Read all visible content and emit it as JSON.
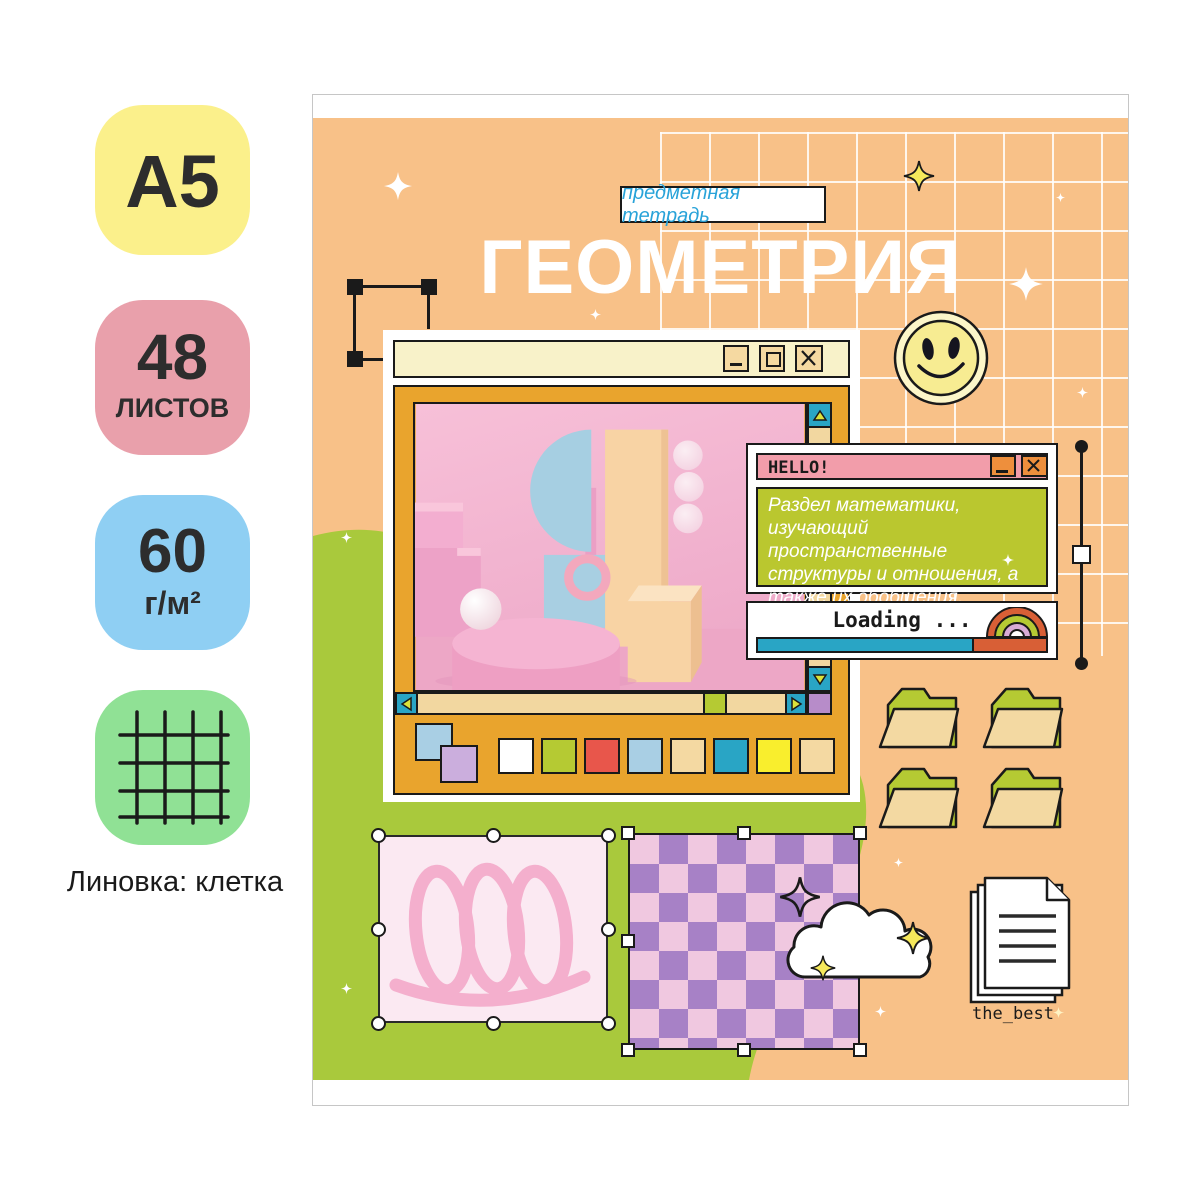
{
  "left_panel": {
    "format_badge": {
      "text": "A5",
      "bg": "#fbf08b"
    },
    "sheets_badge": {
      "number": "48",
      "unit": "ЛИСТОВ",
      "bg": "#e9a0ab"
    },
    "density_badge": {
      "number": "60",
      "unit": "г/м²",
      "bg": "#8fcff3"
    },
    "ruling_badge": {
      "icon": "grid-icon",
      "bg": "#90e195"
    },
    "ruling_label": "Линовка: клетка"
  },
  "cover": {
    "tag": "предметная тетрадь",
    "title": "ГЕОМЕТРИЯ",
    "colors": {
      "cover_orange": "#f8c188",
      "accent_green": "#a9c93c",
      "window_orange": "#e9a42d",
      "teal": "#29a5c5",
      "titlebar_cream": "#f8f2c9"
    },
    "paint_window": {
      "swatches": [
        "#ffffff",
        "#b5ca33",
        "#e8564b",
        "#a9cfe4",
        "#f4d9a2",
        "#29a5c5",
        "#f9ee2d",
        "#f4d9a2"
      ]
    },
    "hello_window": {
      "title": "HELLO!",
      "body": "Раздел математики, изучающий пространственные структуры и отношения, а также их обобщения.",
      "titlebar_color": "#f29daa",
      "body_color": "#bac72f"
    },
    "loading_window": {
      "label": "Loading ...",
      "progress_color": "#29a5c5",
      "remainder_color": "#d85f36"
    },
    "files_label": "the_best"
  }
}
